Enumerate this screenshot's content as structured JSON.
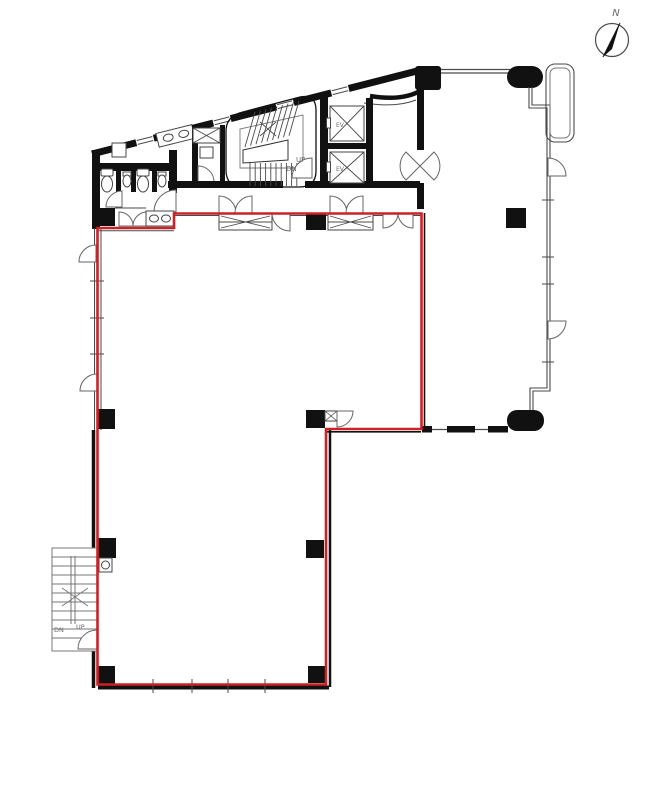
{
  "colors": {
    "lease": "#cb2127",
    "wall": "#111111",
    "thin": "#4a4a4a",
    "label": "#6b6b6b"
  },
  "compass": {
    "label": "N"
  },
  "core": {
    "stairwell": {
      "up_label": "UP",
      "down_label": "DN"
    },
    "elevators": [
      {
        "label": "EV"
      },
      {
        "label": "EV"
      }
    ]
  },
  "external_stair": {
    "up_label": "UP",
    "down_label": "DN"
  }
}
